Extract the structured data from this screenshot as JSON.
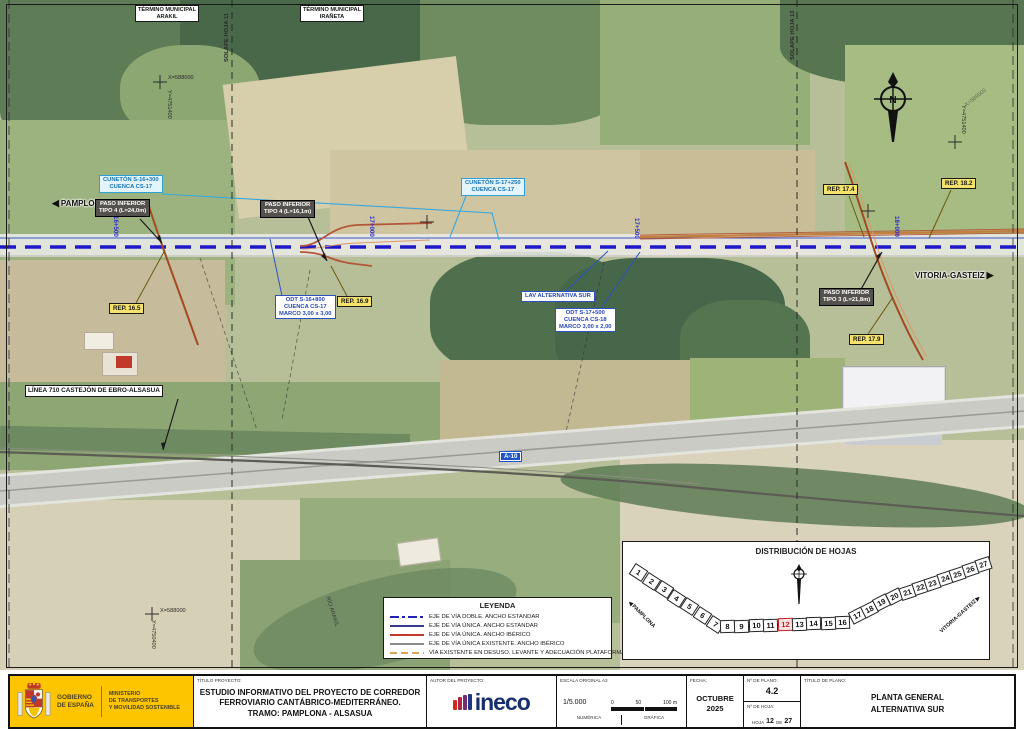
{
  "colors": {
    "standard_double_track": "#2222bb",
    "standard_single_track": "#3a3a8c",
    "iberico_track": "#c0392b",
    "existing_iberico": "#8c8c8c",
    "disused_track": "#d9a35a",
    "gov_yellow": "#fdc400",
    "road_sign_blue": "#1d54c8",
    "highlight_red": "#c81e1e"
  },
  "map": {
    "municipal_1": "TÉRMINO MUNICIPAL\nARAKIL",
    "municipal_2": "TÉRMINO MUNICIPAL\nIRAÑETA",
    "solape_left": "SOLAPE HOJA 11",
    "solape_right": "SOLAPE HOJA 13",
    "direction_left": "PAMPLONA",
    "direction_right": "VITORIA-GASTEIZ",
    "river_label": "RÍO ARAKIL",
    "km_1": "16+500",
    "km_2": "17+000",
    "km_3": "17+500",
    "km_4": "18+000",
    "coord_x_top": "X=588000",
    "coord_y_left_top": "Y=4751400",
    "coord_x_bottom": "X=588000",
    "coord_y_left_bottom": "Y=4750400",
    "coord_y_right": "Y=4751400",
    "coord_x_right": "X=589500",
    "ann": {
      "cuneton1": "CUNETÓN S-16+300\nCUENCA CS-17",
      "cuneton2": "CUNETÓN S-17+250\nCUENCA CS-17",
      "paso1": "PASO INFERIOR\nTIPO 4 (L=24,0m)",
      "paso2": "PASO INFERIOR\nTIPO 4 (L=16,1m)",
      "paso3": "PASO INFERIOR\nTIPO 3 (L=21,8m)",
      "odt1": "ODT S-16+800\nCUENCA CS-17\nMARCO 3,00 x 3,00",
      "odt2": "ODT S-17+500\nCUENCA CS-18\nMARCO 3,00 x 2,00",
      "lav": "LAV ALTERNATIVA SUR",
      "rep165": "REP. 16.5",
      "rep169": "REP. 16.9",
      "rep174": "REP. 17.4",
      "rep179": "REP. 17.9",
      "rep182": "REP. 18.2",
      "linea710": "LÍNEA 710 CASTEJÓN DE EBRO-ALSASUA",
      "a10": "A-10"
    }
  },
  "legend": {
    "title": "LEYENDA",
    "entries": [
      {
        "label": "EJE DE VÍA DOBLE. ANCHO ESTANDAR",
        "color": "#2222bb",
        "style": "dash-dot"
      },
      {
        "label": "EJE DE VÍA ÚNICA. ANCHO ESTANDAR",
        "color": "#3a3a8c",
        "style": "solid"
      },
      {
        "label": "EJE DE VÍA ÚNICA. ANCHO IBÉRICO",
        "color": "#c0392b",
        "style": "solid"
      },
      {
        "label": "EJE DE VÍA ÚNICA EXISTENTE. ANCHO IBÉRICO",
        "color": "#8c8c8c",
        "style": "solid"
      },
      {
        "label": "VÍA EXISTENTE EN DESUSO. LEVANTE Y ADECUACIÓN PLATAFORMA",
        "color": "#d9a35a",
        "style": "dashed"
      }
    ]
  },
  "distribution": {
    "title": "DISTRIBUCIÓN DE HOJAS",
    "sheets": [
      1,
      2,
      3,
      4,
      5,
      6,
      7,
      8,
      9,
      10,
      11,
      12,
      13,
      14,
      15,
      16,
      17,
      18,
      19,
      20,
      21,
      22,
      23,
      24,
      25,
      26,
      27
    ],
    "highlighted": 12,
    "start_label": "PAMPLONA",
    "end_label": "VITORIA-GASTEIZ"
  },
  "titleblock": {
    "gobierno": "GOBIERNO\nDE ESPAÑA",
    "ministerio": "MINISTERIO\nDE TRANSPORTES\nY MOVILIDAD SOSTENIBLE",
    "titulo_proyecto_label": "TÍTULO PROYECTO:",
    "proyecto": "ESTUDIO INFORMATIVO DEL PROYECTO DE CORREDOR\nFERROVIARIO CANTÁBRICO-MEDITERRÁNEO.\nTRAMO: PAMPLONA - ALSASUA",
    "autor_label": "AUTOR DEL PROYECTO:",
    "autor": "ineco",
    "escala_label": "ESCALA ORIGINAL A3",
    "escala_numerica": "1/5.000",
    "tick_0": "0",
    "tick_50": "50",
    "tick_100": "100 m",
    "numerica_label": "NUMÉRICA",
    "grafica_label": "GRÁFICA",
    "fecha_label": "FECHA:",
    "fecha": "OCTUBRE\n2025",
    "plano_label": "Nº DE PLANO:",
    "plano": "4.2",
    "hoja_label": "Nº DE HOJA:",
    "hoja_prefix": "HOJA",
    "hoja_num": "12",
    "hoja_de": "DE",
    "hoja_total": "27",
    "titulo_plano_label": "TÍTULO DE PLANO:",
    "titulo_plano": "PLANTA GENERAL\nALTERNATIVA SUR"
  }
}
